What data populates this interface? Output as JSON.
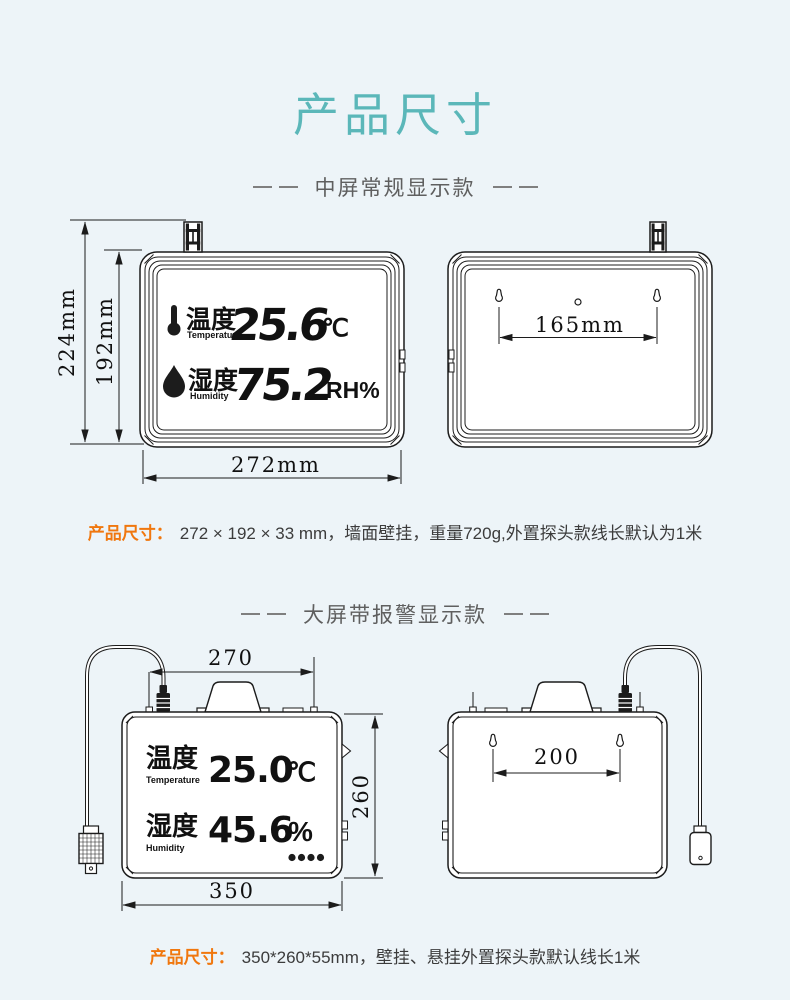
{
  "page": {
    "title": "产品尺寸"
  },
  "colors": {
    "background": "#edf4f8",
    "title_teal": "#5bb7b9",
    "spec_orange": "#f0770e",
    "line_ink": "#1c1c1c",
    "heading_gray": "#5f5f5f"
  },
  "section_medium": {
    "heading": "中屏常规显示款",
    "front": {
      "dim_total_height": "224mm",
      "dim_body_height": "192mm",
      "dim_width": "272mm",
      "display": {
        "temp_label": "温度",
        "temp_sub": "Temperature",
        "temp_value": "25.6",
        "temp_unit": "℃",
        "hum_label": "湿度",
        "hum_sub": "Humidity",
        "hum_value": "75.2",
        "hum_unit": "RH%"
      }
    },
    "back": {
      "dim_hole_spacing": "165mm"
    },
    "spec_label": "产品尺寸：",
    "spec_text": "272 × 192 × 33 mm，墙面壁挂，重量720g,外置探头款线长默认为1米"
  },
  "section_large": {
    "heading": "大屏带报警显示款",
    "front": {
      "dim_top_width": "270",
      "dim_height": "260",
      "dim_bottom_width": "350",
      "display": {
        "temp_label": "温度",
        "temp_sub": "Temperature",
        "temp_value": "25.0",
        "temp_unit": "℃",
        "hum_label": "湿度",
        "hum_sub": "Humidity",
        "hum_value": "45.6",
        "hum_unit": "%"
      }
    },
    "back": {
      "dim_hole_spacing": "200"
    },
    "spec_label": "产品尺寸：",
    "spec_text": "350*260*55mm，壁挂、悬挂外置探头款默认线长1米"
  }
}
